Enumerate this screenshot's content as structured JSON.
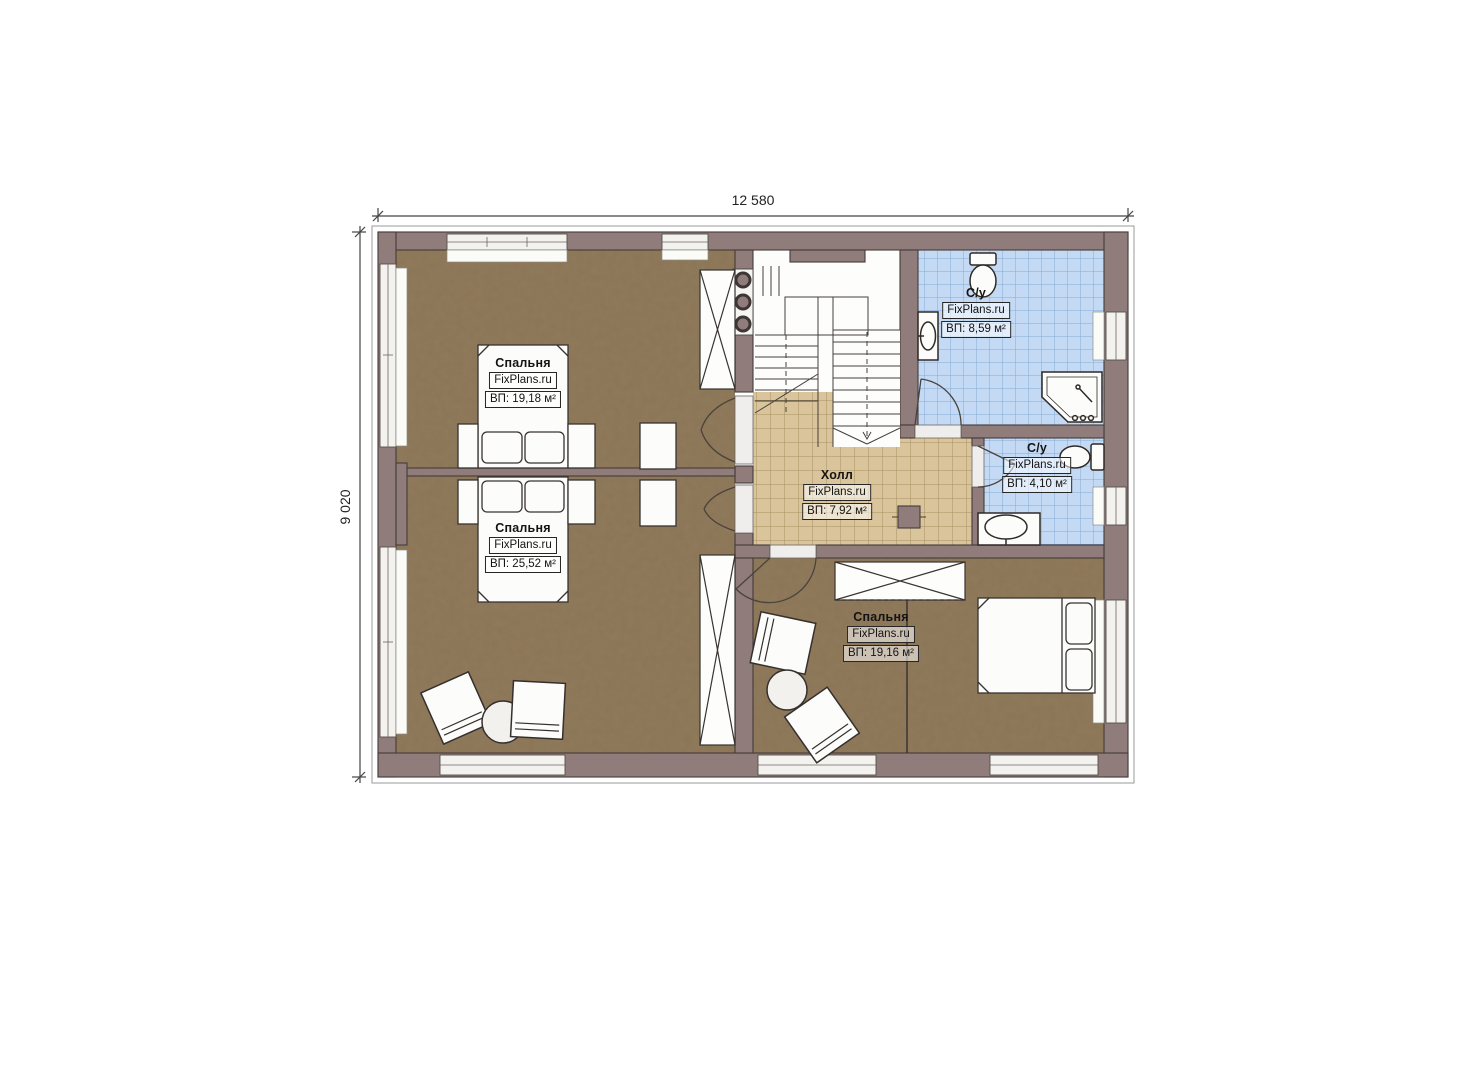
{
  "plan": {
    "dimension_top": "12 580",
    "dimension_left": "9 020",
    "watermark": "FixPlans.ru",
    "rooms": [
      {
        "id": "bedroom-top-left",
        "name": "Спальня",
        "watermark": "FixPlans.ru",
        "area": "ВП: 19,18 м²"
      },
      {
        "id": "bedroom-bottom-left",
        "name": "Спальня",
        "watermark": "FixPlans.ru",
        "area": "ВП: 25,52 м²"
      },
      {
        "id": "hall",
        "name": "Холл",
        "watermark": "FixPlans.ru",
        "area": "ВП: 7,92 м²"
      },
      {
        "id": "bathroom-top",
        "name": "С/у",
        "watermark": "FixPlans.ru",
        "area": "ВП: 8,59 м²"
      },
      {
        "id": "bathroom-right",
        "name": "С/у",
        "watermark": "FixPlans.ru",
        "area": "ВП: 4,10 м²"
      },
      {
        "id": "bedroom-bottom-right",
        "name": "Спальня",
        "watermark": "FixPlans.ru",
        "area": "ВП: 19,16 м²"
      }
    ],
    "colors": {
      "wall": "#8f7c7b",
      "wall_outline": "#443c3a",
      "floor_wood": "#8c7557",
      "tile_hall": "#d9c49c",
      "tile_hall_grid": "#a08754",
      "tile_bath": "#c4daf4",
      "tile_bath_grid": "#84a9d4",
      "fixture_fill": "#fcfcfa",
      "line_dark": "#35302d"
    }
  }
}
